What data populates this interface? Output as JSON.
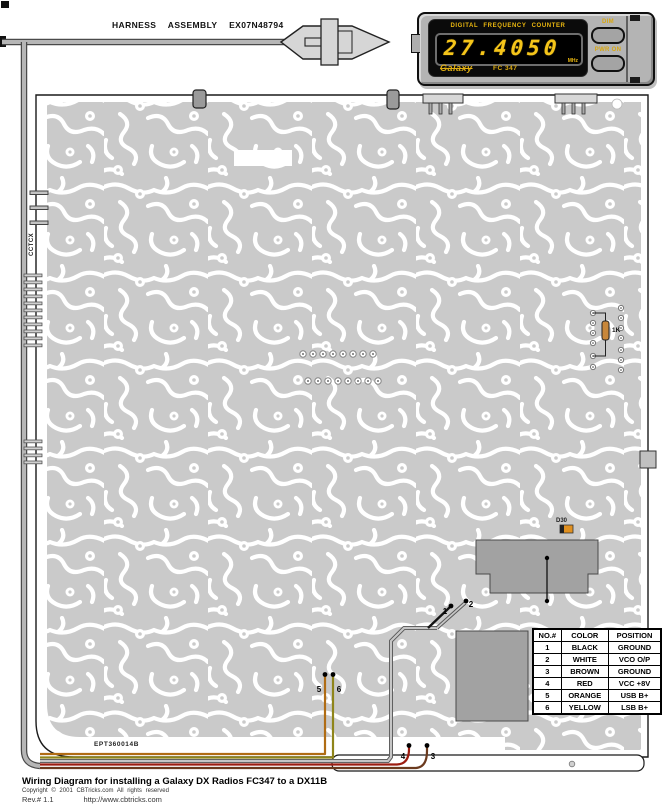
{
  "page": {
    "background": "#ffffff"
  },
  "harness": {
    "label": "HARNESS ASSEMBLY EX07N48794"
  },
  "counter": {
    "title": "DIGITAL FREQUENCY COUNTER",
    "display_value": "27.4050",
    "unit": "MHz",
    "brand": "Galaxy",
    "model": "FC 347",
    "dim_label": "DIM",
    "pwr_label": "PWR ON",
    "digit_color": "#f5c51a",
    "bezel_color": "#b4b4b4"
  },
  "board": {
    "part_number": "EPT360014B",
    "side_label": "CCTCX",
    "d30_label": "D30",
    "r1k_label": "1K",
    "copper_color": "#cacaca"
  },
  "wires": [
    {
      "n": "1",
      "color_name": "BLACK",
      "hex": "#141414"
    },
    {
      "n": "2",
      "color_name": "WHITE",
      "hex": "#c6c6c6"
    },
    {
      "n": "3",
      "color_name": "BROWN",
      "hex": "#6b3a1e"
    },
    {
      "n": "4",
      "color_name": "RED",
      "hex": "#9c1c10"
    },
    {
      "n": "5",
      "color_name": "ORANGE",
      "hex": "#b06c14"
    },
    {
      "n": "6",
      "color_name": "YELLOW",
      "hex": "#8f851a"
    }
  ],
  "pin_table": {
    "headers": [
      "NO.#",
      "COLOR",
      "POSITION"
    ],
    "rows": [
      [
        "1",
        "BLACK",
        "GROUND"
      ],
      [
        "2",
        "WHITE",
        "VCO O/P"
      ],
      [
        "3",
        "BROWN",
        "GROUND"
      ],
      [
        "4",
        "RED",
        "VCC +8V"
      ],
      [
        "5",
        "ORANGE",
        "USB B+"
      ],
      [
        "6",
        "YELLOW",
        "LSB B+"
      ]
    ]
  },
  "footer": {
    "title": "Wiring Diagram for installing a Galaxy DX Radios FC347 to a DX11B",
    "copyright": "Copyright © 2001 CBTricks.com All rights reserved",
    "revision": "Rev.# 1.1",
    "url": "http://www.cbtricks.com"
  }
}
